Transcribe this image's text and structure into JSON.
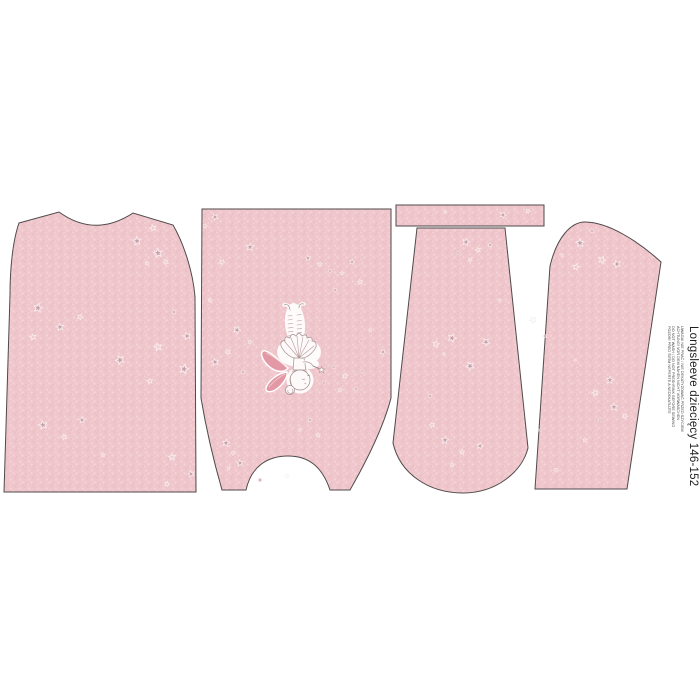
{
  "label": {
    "title": "Longsleeve dziecięcy 146-152",
    "care_instructions": [
      "UWAGA! NIE PRAĆ / NIE DEKATYZOWAĆ PRZED SZYCIEM",
      "ACHTUNG! VOR DEM NÄHEN NICHT VORWASCHEN",
      "DO NOT WASH / DO NOT PRESHRINK BEFORE SEWING",
      "POZOR! PŘED ŠITÍM NEPERTE A NEDEKATUJTE"
    ]
  },
  "colors": {
    "page-bg": "#ffffff",
    "outline": "#4f4a4b",
    "fab-base": "#efc6cb",
    "fab-light": "#f8dde0",
    "fab-dark": "#e2b2ba",
    "star-fill": "#c39ca7",
    "star-halo": "#f8eef0",
    "wing": "#e299a5",
    "label-text": "#1f1f1f"
  }
}
